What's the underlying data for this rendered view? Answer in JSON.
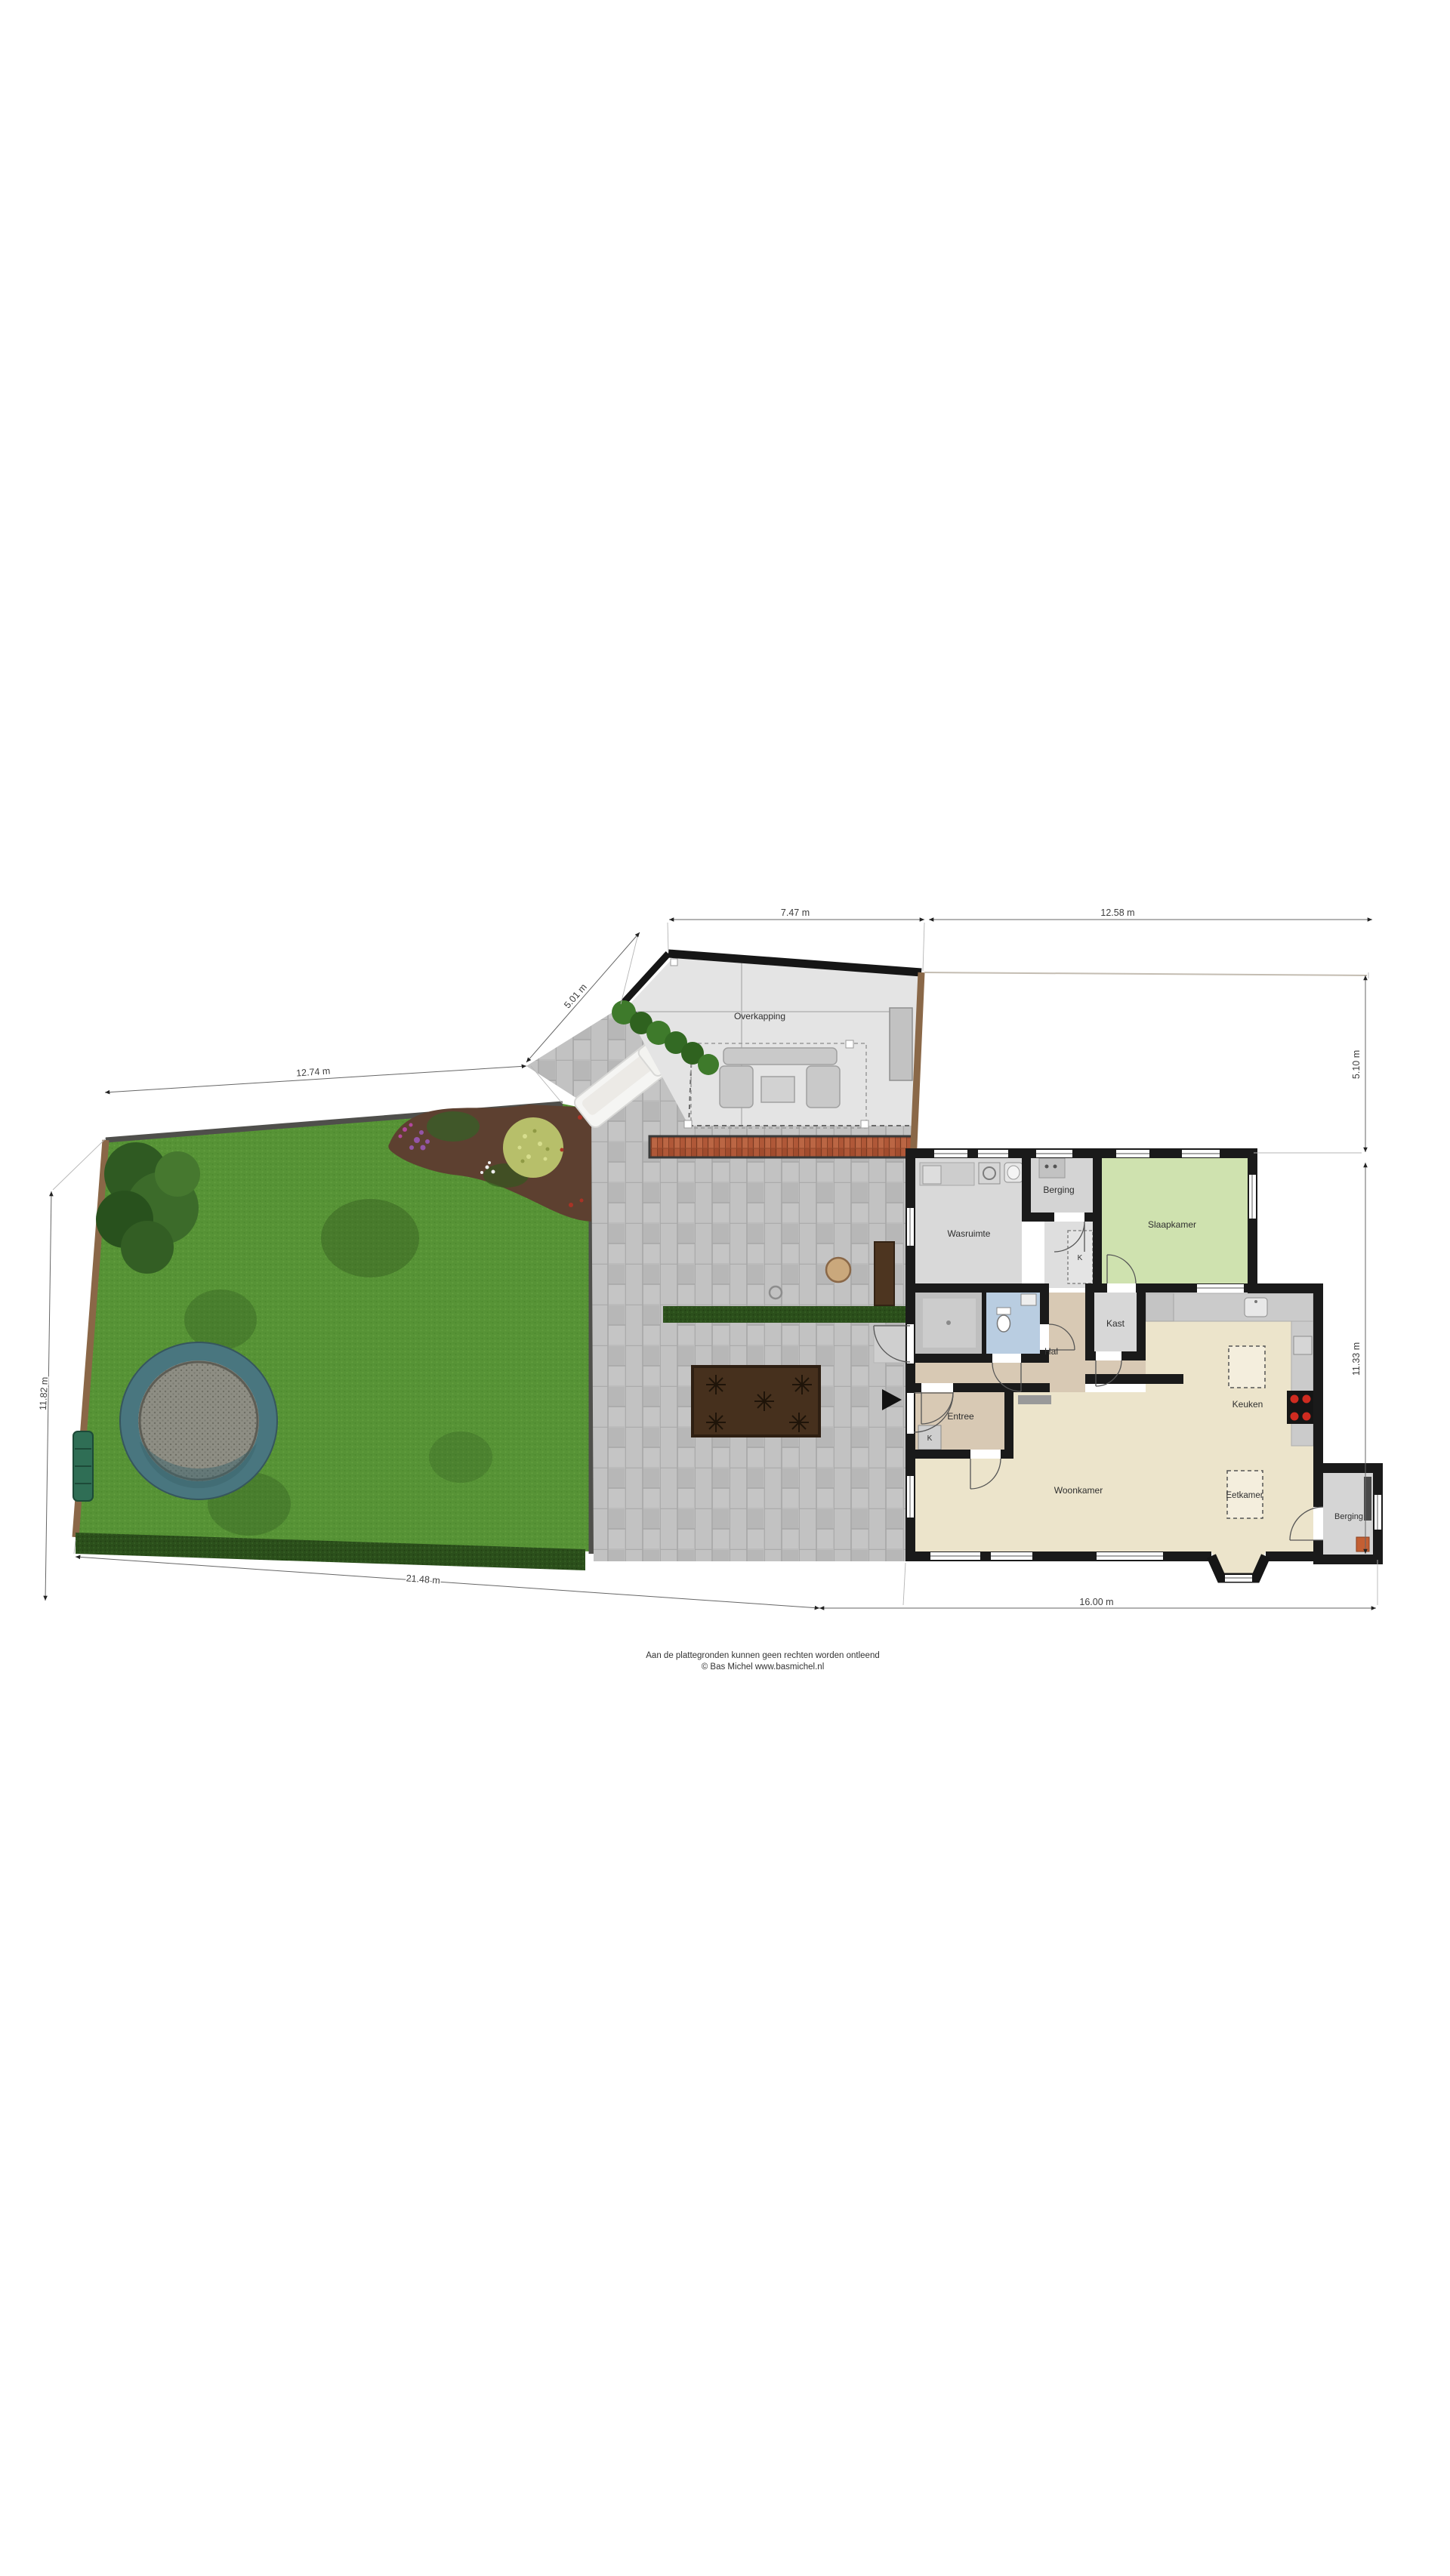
{
  "plan": {
    "outdoor_labels": {
      "overkapping": "Overkapping"
    },
    "rooms": {
      "wasruimte": "Wasruimte",
      "berging_top": "Berging",
      "slaapkamer": "Slaapkamer",
      "hal": "Hal",
      "kast": "Kast",
      "closet_k1": "K",
      "closet_k2": "K",
      "entree": "Entree",
      "woonkamer": "Woonkamer",
      "keuken": "Keuken",
      "eetkamer": "Eetkamer",
      "berging_rear": "Berging"
    },
    "dimensions": {
      "overkapping_top": "7.47 m",
      "plot_top_right": "12.58 m",
      "fence_diagonal": "5.01 m",
      "garden_top": "12.74 m",
      "garden_left": "11.82 m",
      "garden_bottom": "21.48 m",
      "house_bottom": "16.00 m",
      "right_upper": "5.10 m",
      "right_lower": "11.33 m"
    },
    "footer": {
      "line1": "Aan de plattegronden kunnen geen rechten worden ontleend",
      "line2": "© Bas Michel www.basmichel.nl"
    },
    "palette": {
      "lawn": "#579336",
      "hedge": "#2b4f1b",
      "pavers": "#bcbcbc",
      "brick": "#b05838",
      "wall": "#1a1a1a",
      "floor_grey": "#d9d9d9",
      "floor_tan": "#d8c9b4",
      "floor_cream": "#ece4cb",
      "floor_bedroom": "#cfe2af",
      "floor_toilet": "#b9cde1",
      "trampoline_ring": "#49767f",
      "fence_wood": "#8a6747",
      "stove_burner": "#cf2b20"
    }
  }
}
